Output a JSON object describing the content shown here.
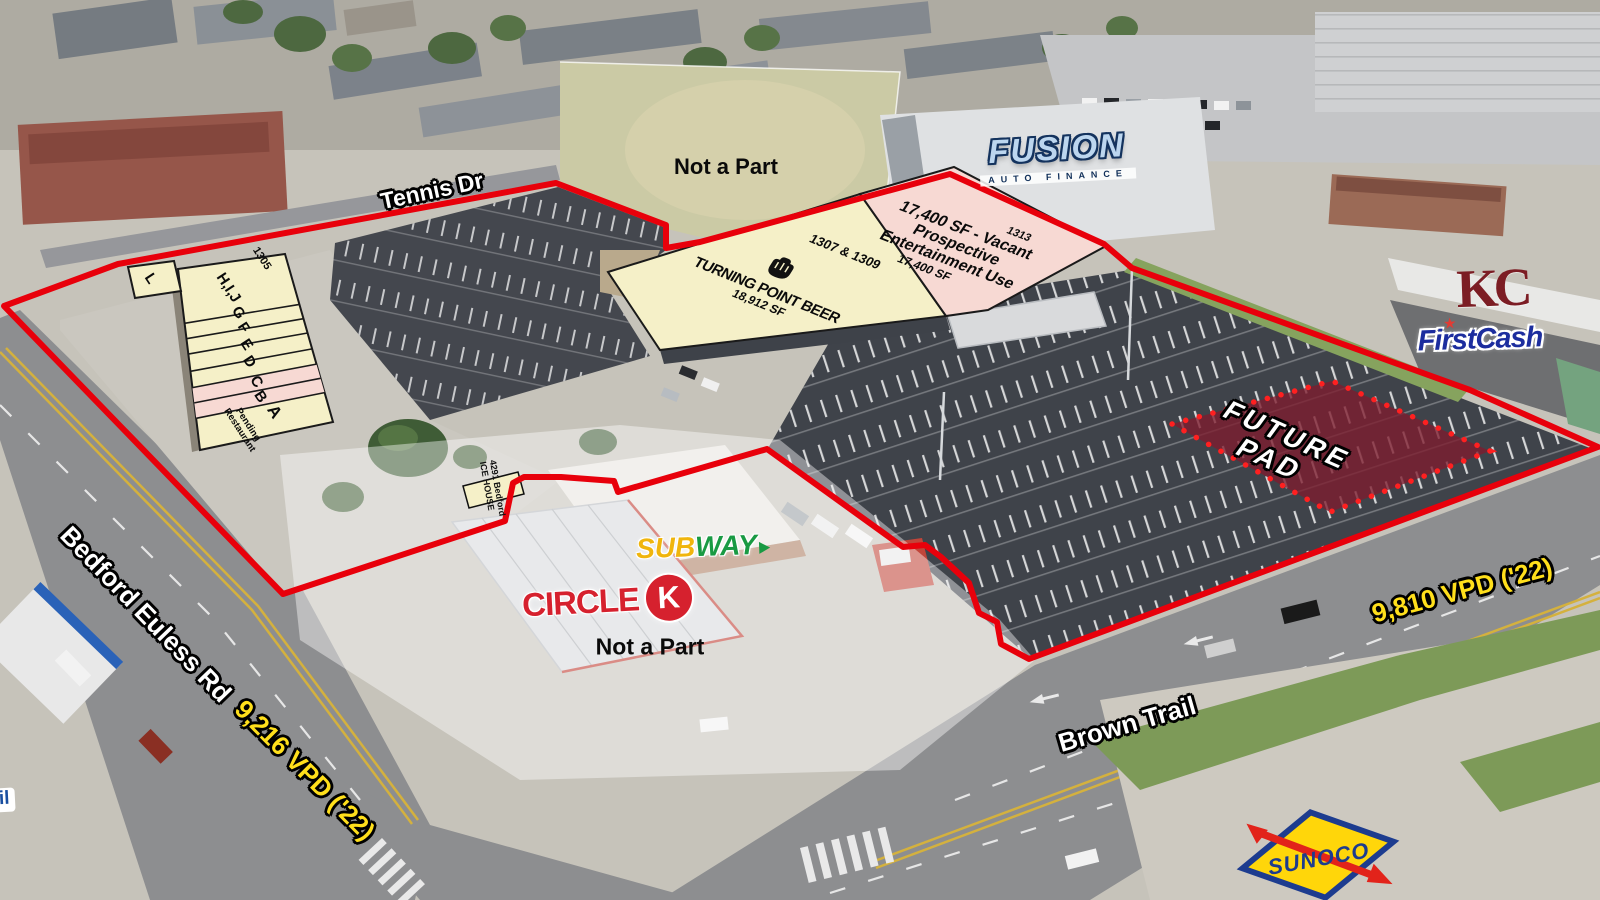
{
  "map": {
    "roads": {
      "tennis_dr": "Tennis Dr",
      "bedford_euless": "Bedford Euless Rd",
      "bedford_vpd": "9,216 VPD ('22)",
      "brown_trail": "Brown Trail",
      "brown_vpd": "9,810 VPD ('22)"
    },
    "exclusions": {
      "north_field": "Not a Part",
      "gas_corner": "Not a Part"
    },
    "future_pad": {
      "word1": "FUTURE",
      "word2": "PAD"
    }
  },
  "parcels": {
    "suite_1313": {
      "address": "1313",
      "headline": "17,400 SF - Vacant",
      "line2": "Prospective",
      "line3": "Entertainment Use",
      "size": "17,400 SF"
    },
    "suite_1307_1309": {
      "address": "1307 & 1309",
      "tenant": "TURNING POINT BEER",
      "size": "18,912 SF"
    },
    "strip_1305": {
      "address": "1305",
      "units": [
        "L",
        "H,I,J",
        "G",
        "F",
        "E",
        "D",
        "C",
        "B",
        "A"
      ],
      "unit_a_status_line1": "Pending",
      "unit_a_status_line2": "Restaurant"
    },
    "ice_house": {
      "line1": "4291 Bedford",
      "line2": "ICE HOUSE"
    }
  },
  "tenants": {
    "fusion": {
      "name": "FUSION",
      "tagline": "AUTO FINANCE"
    },
    "kc_realty": {
      "initials": "KC"
    },
    "firstcash": {
      "name": "FirstCash",
      "star": "★"
    },
    "subway": {
      "part1": "SUB",
      "part2": "WAY"
    },
    "circle_k": {
      "word": "CIRCLE",
      "letter": "K"
    },
    "sunoco": {
      "name": "SUNOCO"
    },
    "mobil": {
      "fragment": "il"
    }
  },
  "colors": {
    "boundary_red": "#e8000b",
    "overlay_yellow": "#f5f0c8",
    "overlay_pink": "#f7d9d3",
    "future_pad_maroon": "#7d1c2e",
    "vpd_yellow": "#ffdf1b"
  }
}
